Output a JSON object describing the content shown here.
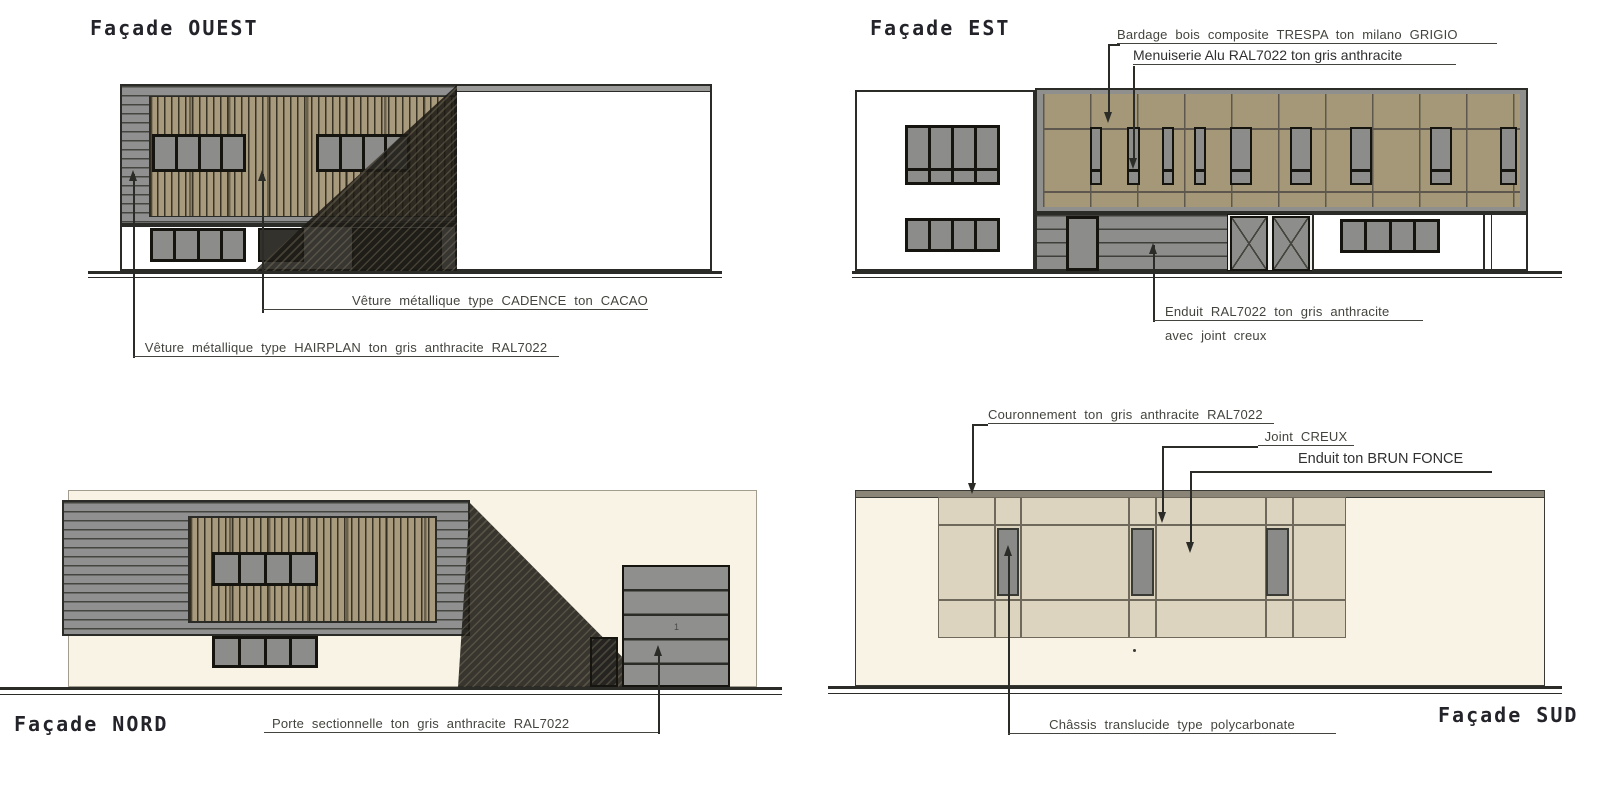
{
  "facades": {
    "ouest": {
      "title": "Façade OUEST",
      "annotations": {
        "cadence": "Vêture métallique type CADENCE ton CACAO",
        "hairplan": "Vêture métallique type HAIRPLAN ton gris anthracite RAL7022"
      }
    },
    "est": {
      "title": "Façade EST",
      "annotations": {
        "bardage": "Bardage bois composite TRESPA ton milano GRIGIO",
        "menuiserie": "Menuiserie Alu RAL7022 ton gris anthracite",
        "enduit_line1": "Enduit RAL7022 ton gris anthracite",
        "enduit_line2": "avec joint creux"
      }
    },
    "nord": {
      "title": "Façade NORD",
      "door_mark": "1",
      "annotations": {
        "porte": "Porte sectionnelle ton gris anthracite RAL7022"
      }
    },
    "sud": {
      "title": "Façade SUD",
      "annotations": {
        "couronnement": "Couronnement ton gris anthracite RAL7022",
        "joint_creux": "Joint CREUX",
        "enduit_brun": "Enduit ton BRUN FONCE",
        "chassis": "Châssis translucide type polycarbonate"
      }
    }
  },
  "materials": {
    "cladding_tan_hex": "#a89a7c",
    "cladding_gray_hex": "#909090",
    "trespa_hex": "#a59878",
    "window_pane_hex": "#8c8c8a",
    "shadow_hex": "#1c1a15",
    "cream_hex": "#f8f3e4",
    "beige_panel_hex": "#ddd4bf",
    "line_hex": "#2b2b28"
  }
}
